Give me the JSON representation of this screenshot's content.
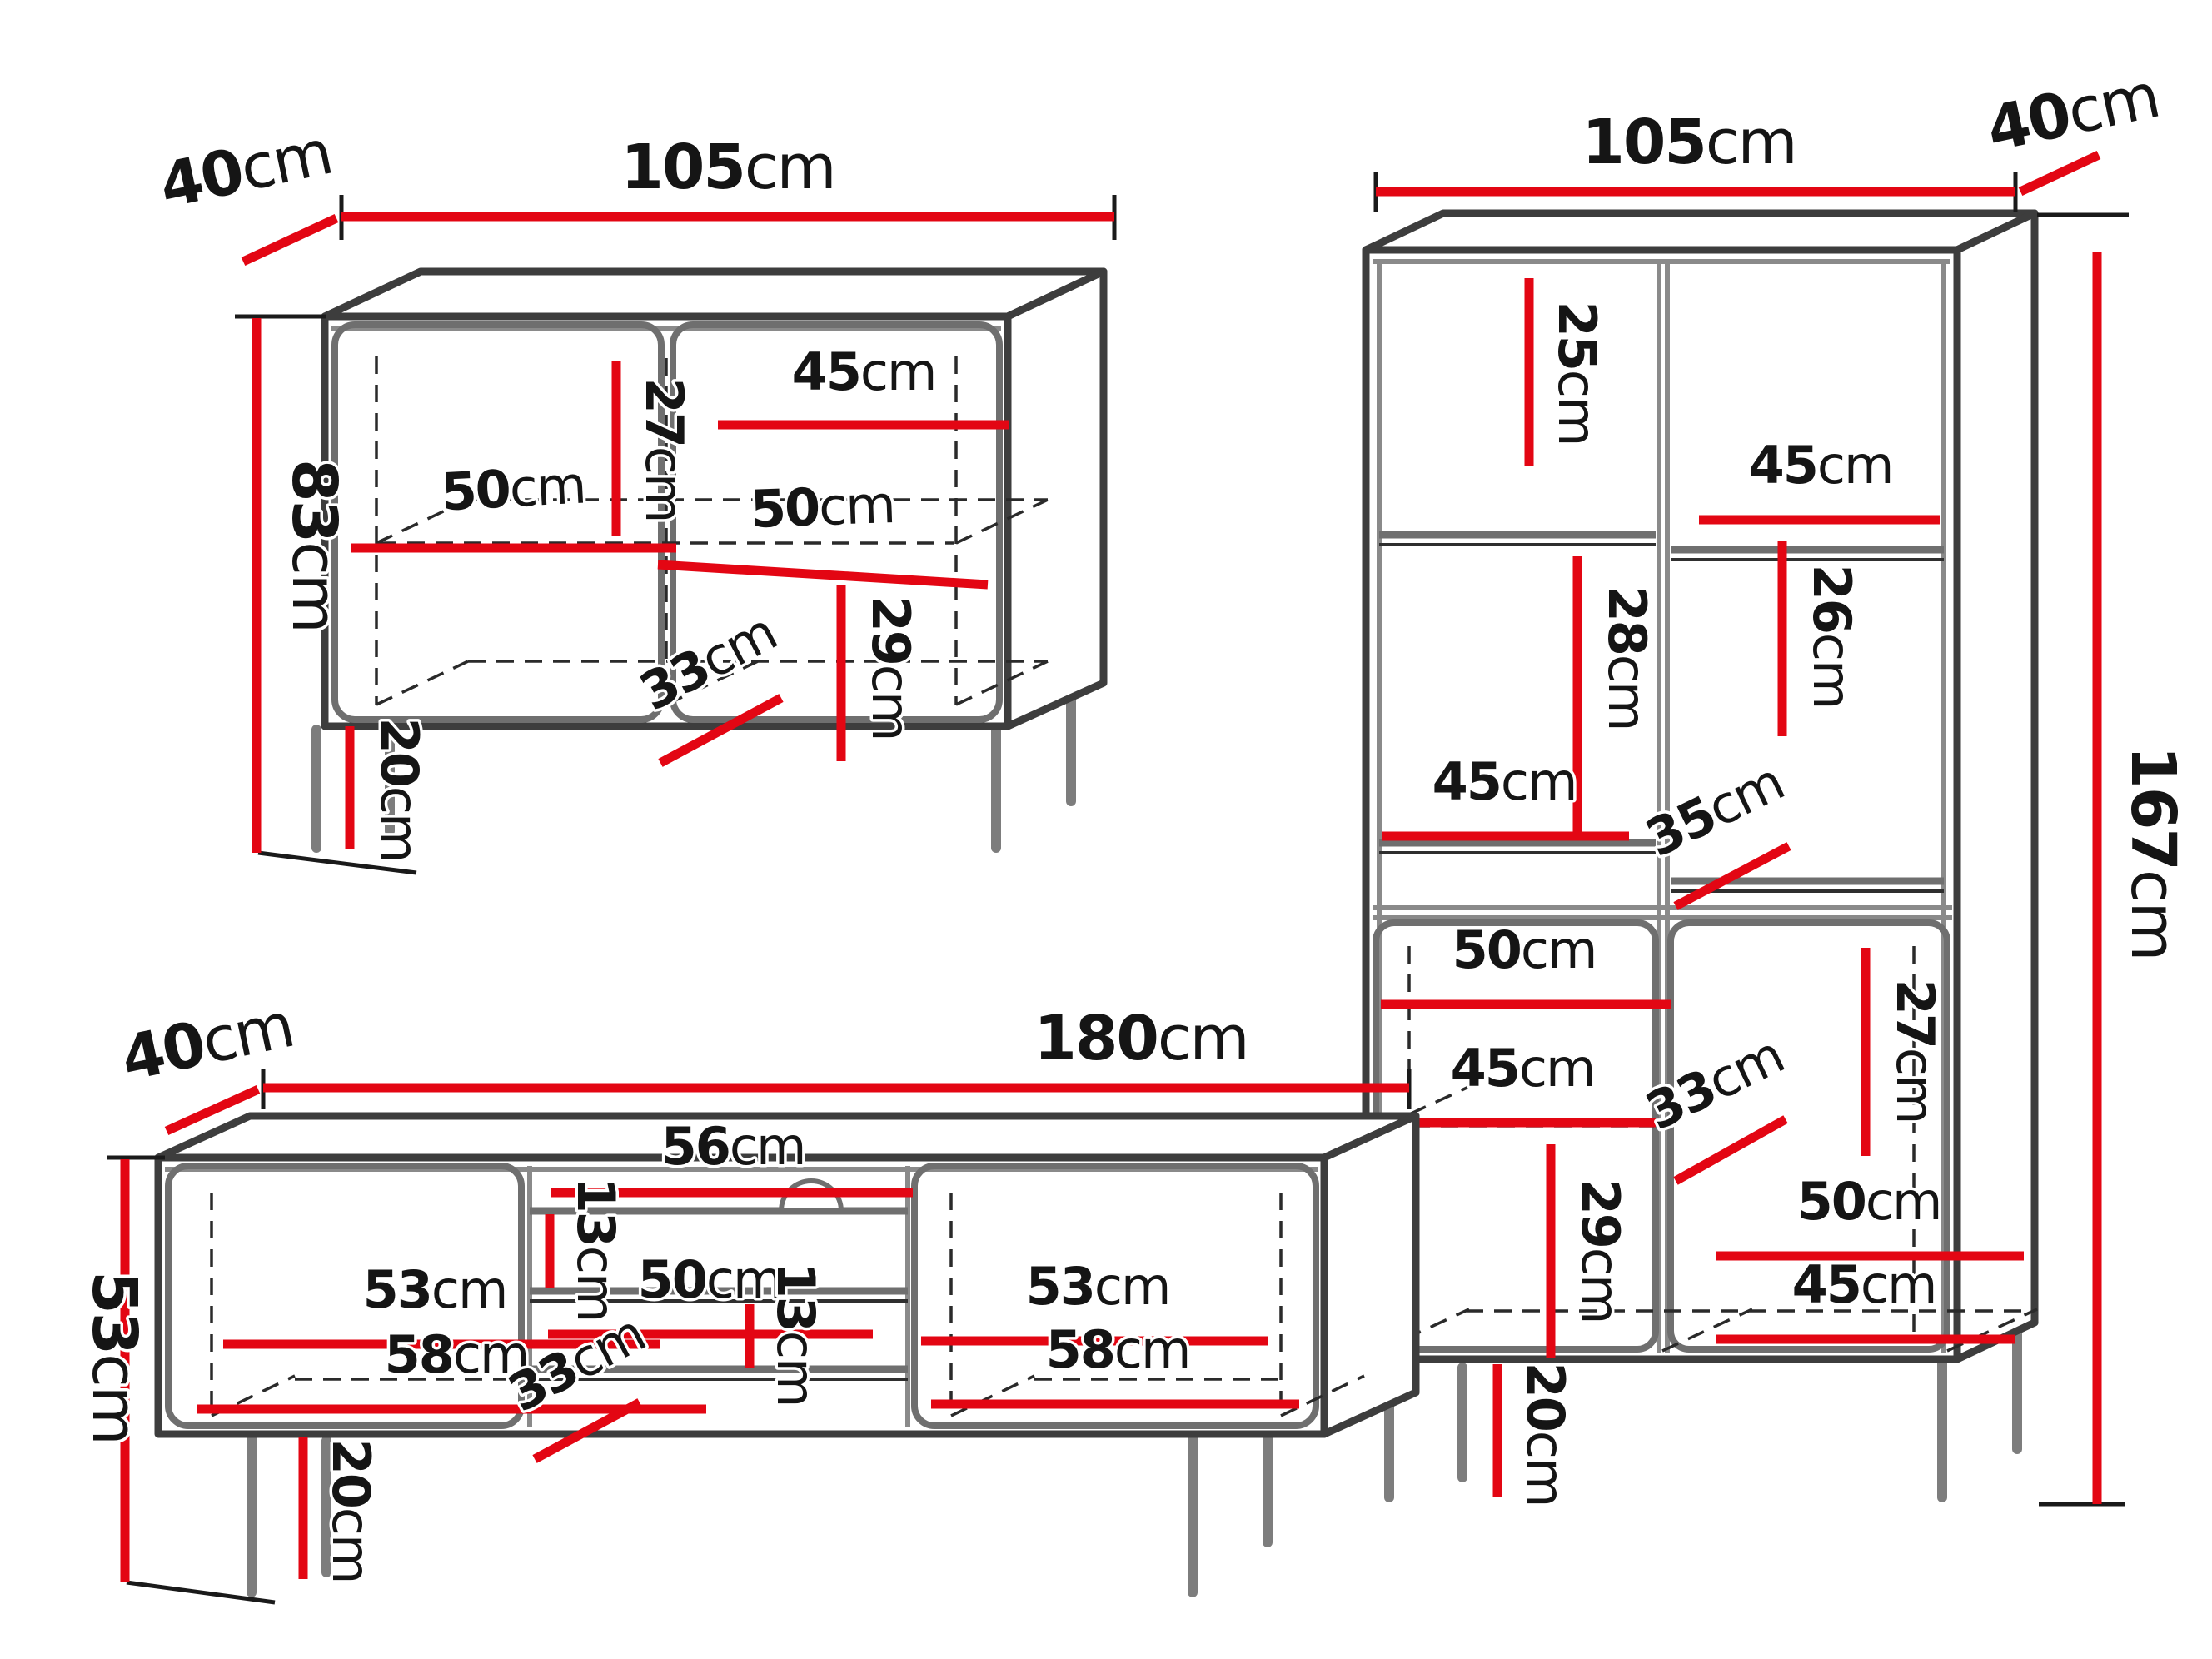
{
  "unit": "cm",
  "colors": {
    "dimension_line": "#e30613",
    "outline": "#3d3d3d",
    "text": "#151515"
  },
  "pieces": [
    {
      "name": "sideboard",
      "overall": {
        "width": {
          "num": "105",
          "unit": "cm"
        },
        "depth": {
          "num": "40",
          "unit": "cm"
        },
        "height": {
          "num": "83",
          "unit": "cm"
        }
      },
      "dims": {
        "shelf_height_upper": {
          "num": "27",
          "unit": "cm"
        },
        "right_top_width": {
          "num": "45",
          "unit": "cm"
        },
        "left_shelf_width": {
          "num": "50",
          "unit": "cm"
        },
        "right_shelf_width": {
          "num": "50",
          "unit": "cm"
        },
        "lower_right_height": {
          "num": "29",
          "unit": "cm"
        },
        "interior_depth": {
          "num": "33",
          "unit": "cm"
        },
        "leg_height": {
          "num": "20",
          "unit": "cm"
        }
      }
    },
    {
      "name": "display-cabinet",
      "overall": {
        "width": {
          "num": "105",
          "unit": "cm"
        },
        "depth": {
          "num": "40",
          "unit": "cm"
        },
        "height": {
          "num": "167",
          "unit": "cm"
        }
      },
      "dims": {
        "top_left_height": {
          "num": "25",
          "unit": "cm"
        },
        "upper_right_width": {
          "num": "45",
          "unit": "cm"
        },
        "upper_right_height": {
          "num": "26",
          "unit": "cm"
        },
        "middle_left_width": {
          "num": "45",
          "unit": "cm"
        },
        "middle_left_height": {
          "num": "28",
          "unit": "cm"
        },
        "middle_depth": {
          "num": "35",
          "unit": "cm"
        },
        "lower_left_width": {
          "num": "50",
          "unit": "cm"
        },
        "lower_right_height": {
          "num": "27",
          "unit": "cm"
        },
        "lower_left_shelf_width": {
          "num": "45",
          "unit": "cm"
        },
        "lower_depth": {
          "num": "33",
          "unit": "cm"
        },
        "lower_left_height": {
          "num": "29",
          "unit": "cm"
        },
        "bottom_right_width": {
          "num": "50",
          "unit": "cm"
        },
        "bottom_right_shelf": {
          "num": "45",
          "unit": "cm"
        },
        "leg_height": {
          "num": "20",
          "unit": "cm"
        }
      }
    },
    {
      "name": "tv-stand",
      "overall": {
        "width": {
          "num": "180",
          "unit": "cm"
        },
        "depth": {
          "num": "40",
          "unit": "cm"
        },
        "height": {
          "num": "53",
          "unit": "cm"
        }
      },
      "dims": {
        "left_width": {
          "num": "53",
          "unit": "cm"
        },
        "left_back_width": {
          "num": "58",
          "unit": "cm"
        },
        "niche_top_height": {
          "num": "13",
          "unit": "cm"
        },
        "niche_top_width": {
          "num": "56",
          "unit": "cm"
        },
        "niche_middle_width": {
          "num": "50",
          "unit": "cm"
        },
        "niche_lower_height": {
          "num": "13",
          "unit": "cm"
        },
        "interior_depth": {
          "num": "33",
          "unit": "cm"
        },
        "right_width": {
          "num": "53",
          "unit": "cm"
        },
        "right_back_width": {
          "num": "58",
          "unit": "cm"
        },
        "leg_height": {
          "num": "20",
          "unit": "cm"
        }
      }
    }
  ]
}
